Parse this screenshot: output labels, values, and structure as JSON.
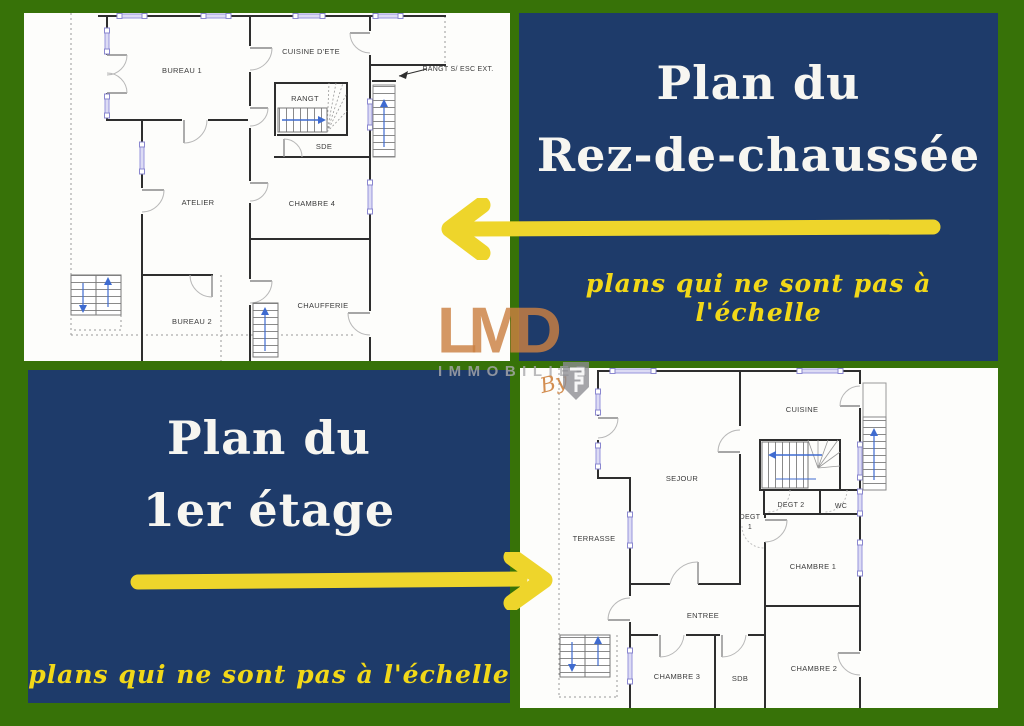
{
  "colors": {
    "frame_green": "#377208",
    "panel_blue": "#1e3b6a",
    "accent_yellow": "#eed52b",
    "note_yellow": "#f2d818",
    "title_white": "#f7f6f1",
    "logo_orange": "#cb8042",
    "logo_gray": "#aaaaac"
  },
  "panels": {
    "ground": {
      "title_line1": "Plan du",
      "title_line2": "Rez-de-chaussée",
      "note": "plans qui ne sont pas à l'échelle"
    },
    "first": {
      "title_line1": "Plan du",
      "title_line2": "1er étage",
      "note": "plans qui ne sont pas à l'échelle"
    }
  },
  "watermark": {
    "name": "LMD",
    "subtitle": "IMMOBILIER",
    "by": "By"
  },
  "ground_plan": {
    "rooms": {
      "bureau1": "BUREAU 1",
      "cuisine_ete": "CUISINE D'ETE",
      "rangt": "RANGT",
      "sde": "SDE",
      "atelier": "ATELIER",
      "chambre4": "CHAMBRE 4",
      "chaufferie": "CHAUFFERIE",
      "bureau2": "BUREAU 2",
      "rangt_ext": "RANGT S/ ESC EXT."
    }
  },
  "first_plan": {
    "rooms": {
      "cuisine": "CUISINE",
      "sejour": "SEJOUR",
      "degt2": "DEGT 2",
      "wc": "WC",
      "degt1_l1": "DEGT",
      "degt1_l2": "1",
      "terrasse": "TERRASSE",
      "chambre1": "CHAMBRE 1",
      "entree": "ENTREE",
      "chambre3": "CHAMBRE 3",
      "sdb": "SDB",
      "chambre2": "CHAMBRE 2"
    }
  }
}
